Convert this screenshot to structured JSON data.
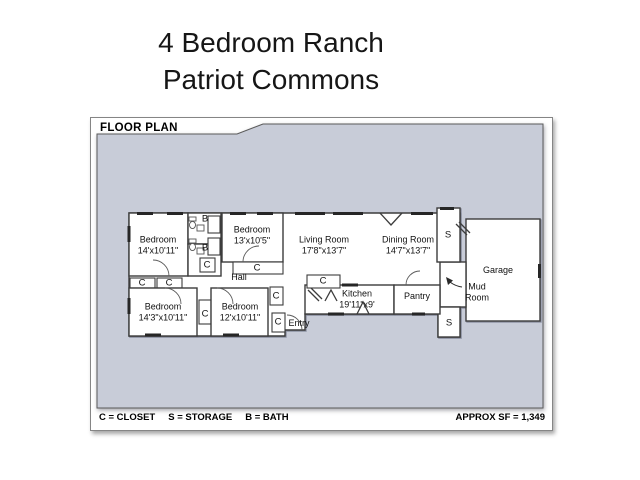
{
  "title": {
    "line1": "4 Bedroom Ranch",
    "line2": "Patriot Commons"
  },
  "plan": {
    "header": "FLOOR PLAN",
    "legend": {
      "closet": "C = CLOSET",
      "storage": "S = STORAGE",
      "bath": "B = BATH"
    },
    "approx_sf": "APPROX SF = 1,349"
  },
  "rooms": {
    "bedroom1": {
      "name": "Bedroom",
      "dims": "14'x10'11\""
    },
    "bedroom2": {
      "name": "Bedroom",
      "dims": "13'x10'5\""
    },
    "living": {
      "name": "Living Room",
      "dims": "17'8\"x13'7\""
    },
    "dining": {
      "name": "Dining Room",
      "dims": "14'7\"x13'7\""
    },
    "garage": {
      "name": "Garage"
    },
    "mudroom": {
      "name": "Mud Room"
    },
    "pantry": {
      "name": "Pantry"
    },
    "kitchen": {
      "name": "Kitchen",
      "dims": "19'11\"x9'"
    },
    "hall": {
      "name": "Hall"
    },
    "entry": {
      "name": "Entry"
    },
    "bedroom3": {
      "name": "Bedroom",
      "dims": "14'3\"x10'11\""
    },
    "bedroom4": {
      "name": "Bedroom",
      "dims": "12'x10'11\""
    }
  },
  "markers": {
    "closet": "C",
    "storage": "S",
    "bath": "B"
  },
  "colors": {
    "backdrop": "#c8ccd8",
    "wall": "#3c3c3c",
    "text": "#121212"
  }
}
